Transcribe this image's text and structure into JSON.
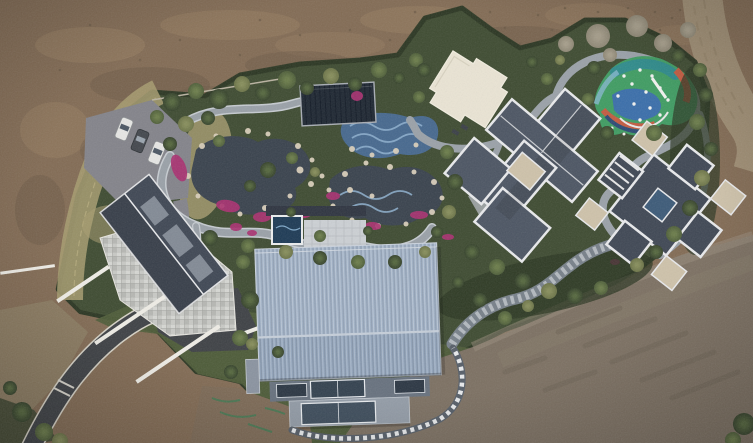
{
  "scene": {
    "description": "Aerial drone view of a landscaped private estate: koi ponds with winding stone paths, a colorful playground, four buildings (stone-roof house, barn with blue metal roof, two gray hip-roof villas), a parking lot with three cars, surrounded by bare graded dirt",
    "counts": {
      "cars": 3,
      "buildings": 5,
      "ponds": 2
    },
    "trees": [
      [
        172,
        102,
        9,
        "d"
      ],
      [
        196,
        91,
        8,
        "m"
      ],
      [
        219,
        99,
        10,
        "d"
      ],
      [
        242,
        84,
        8,
        "o"
      ],
      [
        263,
        93,
        8,
        "d"
      ],
      [
        287,
        80,
        9,
        "m"
      ],
      [
        307,
        88,
        7,
        "d"
      ],
      [
        331,
        76,
        8,
        "o"
      ],
      [
        355,
        84,
        7,
        "d"
      ],
      [
        379,
        70,
        8,
        "m"
      ],
      [
        399,
        78,
        6,
        "d"
      ],
      [
        416,
        60,
        7,
        "m"
      ],
      [
        186,
        124,
        8,
        "o"
      ],
      [
        170,
        144,
        7,
        "d"
      ],
      [
        157,
        117,
        7,
        "m"
      ],
      [
        268,
        170,
        8,
        "d"
      ],
      [
        292,
        158,
        6,
        "m"
      ],
      [
        250,
        186,
        6,
        "d"
      ],
      [
        315,
        172,
        5,
        "o"
      ],
      [
        210,
        238,
        8,
        "d"
      ],
      [
        248,
        246,
        7,
        "m"
      ],
      [
        286,
        252,
        7,
        "o"
      ],
      [
        320,
        258,
        7,
        "d"
      ],
      [
        358,
        262,
        7,
        "m"
      ],
      [
        395,
        262,
        7,
        "d"
      ],
      [
        425,
        252,
        6,
        "o"
      ],
      [
        447,
        152,
        7,
        "m"
      ],
      [
        455,
        182,
        8,
        "d"
      ],
      [
        449,
        212,
        7,
        "o"
      ],
      [
        437,
        232,
        6,
        "d"
      ],
      [
        424,
        70,
        7,
        "d"
      ],
      [
        419,
        97,
        6,
        "m"
      ],
      [
        532,
        62,
        6,
        "d"
      ],
      [
        547,
        79,
        6,
        "m"
      ],
      [
        560,
        60,
        5,
        "o"
      ],
      [
        594,
        68,
        7,
        "d"
      ],
      [
        588,
        99,
        6,
        "m"
      ],
      [
        607,
        133,
        7,
        "d"
      ],
      [
        654,
        133,
        8,
        "m"
      ],
      [
        678,
        56,
        7,
        "d"
      ],
      [
        700,
        70,
        7,
        "m"
      ],
      [
        706,
        95,
        7,
        "d"
      ],
      [
        697,
        122,
        8,
        "m"
      ],
      [
        711,
        149,
        7,
        "d"
      ],
      [
        702,
        178,
        8,
        "o"
      ],
      [
        690,
        208,
        8,
        "d"
      ],
      [
        674,
        234,
        8,
        "m"
      ],
      [
        656,
        252,
        7,
        "d"
      ],
      [
        637,
        265,
        7,
        "o"
      ],
      [
        472,
        252,
        8,
        "d"
      ],
      [
        497,
        267,
        8,
        "m"
      ],
      [
        523,
        281,
        8,
        "d"
      ],
      [
        549,
        291,
        8,
        "o"
      ],
      [
        575,
        296,
        8,
        "d"
      ],
      [
        601,
        288,
        7,
        "m"
      ],
      [
        250,
        300,
        9,
        "d"
      ],
      [
        240,
        338,
        8,
        "m"
      ],
      [
        252,
        344,
        6,
        "o"
      ],
      [
        278,
        352,
        6,
        "d"
      ],
      [
        231,
        372,
        7,
        "d"
      ],
      [
        480,
        300,
        7,
        "d"
      ],
      [
        505,
        318,
        7,
        "m"
      ],
      [
        528,
        306,
        6,
        "o"
      ],
      [
        458,
        282,
        6,
        "d"
      ],
      [
        320,
        236,
        6,
        "m"
      ],
      [
        368,
        231,
        5,
        "d"
      ],
      [
        291,
        212,
        5,
        "d"
      ],
      [
        744,
        424,
        11,
        "d"
      ],
      [
        733,
        440,
        8,
        "m"
      ],
      [
        22,
        412,
        10,
        "d"
      ],
      [
        44,
        432,
        9,
        "m"
      ],
      [
        10,
        388,
        7,
        "d"
      ],
      [
        60,
        441,
        8,
        "o"
      ],
      [
        243,
        262,
        7,
        "m"
      ],
      [
        208,
        118,
        7,
        "d"
      ],
      [
        219,
        141,
        6,
        "m"
      ],
      [
        598,
        36,
        12,
        "b"
      ],
      [
        637,
        26,
        11,
        "b"
      ],
      [
        663,
        43,
        9,
        "b"
      ],
      [
        566,
        44,
        8,
        "b"
      ],
      [
        610,
        55,
        7,
        "b"
      ],
      [
        688,
        30,
        8,
        "b"
      ]
    ],
    "rocks": [
      [
        202,
        146,
        3
      ],
      [
        216,
        136,
        2.5
      ],
      [
        248,
        131,
        3
      ],
      [
        268,
        134,
        2.5
      ],
      [
        298,
        146,
        3
      ],
      [
        312,
        160,
        2.5
      ],
      [
        311,
        184,
        3
      ],
      [
        290,
        196,
        2.5
      ],
      [
        265,
        208,
        3
      ],
      [
        240,
        214,
        2.5
      ],
      [
        222,
        206,
        2.5
      ],
      [
        198,
        196,
        2.5
      ],
      [
        188,
        176,
        3
      ],
      [
        345,
        174,
        3
      ],
      [
        366,
        163,
        2.5
      ],
      [
        390,
        167,
        3
      ],
      [
        414,
        172,
        2.5
      ],
      [
        434,
        182,
        3
      ],
      [
        442,
        198,
        2.5
      ],
      [
        432,
        212,
        3
      ],
      [
        406,
        224,
        2.5
      ],
      [
        378,
        226,
        3
      ],
      [
        352,
        220,
        2.5
      ],
      [
        333,
        206,
        2.5
      ],
      [
        329,
        190,
        2.5
      ],
      [
        352,
        149,
        3
      ],
      [
        372,
        155,
        2.5
      ],
      [
        396,
        151,
        3
      ],
      [
        416,
        145,
        2.5
      ],
      [
        300,
        170,
        3.5
      ],
      [
        350,
        190,
        3
      ],
      [
        372,
        196,
        2.5
      ],
      [
        322,
        176,
        2.5
      ]
    ],
    "flowers": [
      [
        179,
        168,
        7,
        14,
        -20
      ],
      [
        228,
        206,
        12,
        6,
        10
      ],
      [
        262,
        217,
        9,
        5,
        0
      ],
      [
        301,
        213,
        10,
        5,
        8
      ],
      [
        333,
        196,
        7,
        4,
        0
      ],
      [
        373,
        226,
        8,
        4,
        5
      ],
      [
        419,
        215,
        9,
        4,
        0
      ],
      [
        448,
        237,
        6,
        3,
        0
      ],
      [
        236,
        227,
        6,
        4,
        0
      ],
      [
        252,
        233,
        5,
        3,
        0
      ],
      [
        357,
        96,
        6,
        5,
        0
      ],
      [
        615,
        262,
        5,
        3,
        0
      ]
    ],
    "dirt_streaks": [
      [
        90,
        45,
        55,
        18,
        "light",
        0.45
      ],
      [
        230,
        25,
        70,
        15,
        "light",
        0.4
      ],
      [
        420,
        20,
        60,
        14,
        "light",
        0.4
      ],
      [
        590,
        15,
        45,
        12,
        "light",
        0.35
      ],
      [
        55,
        130,
        35,
        28,
        "light",
        0.4
      ],
      [
        330,
        45,
        55,
        13,
        "light",
        0.35
      ],
      [
        680,
        35,
        30,
        10,
        "light",
        0.3
      ],
      [
        150,
        85,
        60,
        18,
        "dark",
        0.45
      ],
      [
        300,
        65,
        55,
        14,
        "dark",
        0.4
      ],
      [
        520,
        38,
        55,
        12,
        "dark",
        0.4
      ],
      [
        640,
        55,
        35,
        10,
        "dark",
        0.4
      ],
      [
        40,
        210,
        25,
        35,
        "dark",
        0.45
      ],
      [
        110,
        150,
        30,
        20,
        "dark",
        0.4
      ],
      [
        210,
        100,
        40,
        14,
        "dark",
        0.35
      ]
    ],
    "dirt_speckles": [
      [
        455,
        18
      ],
      [
        470,
        35
      ],
      [
        490,
        12
      ],
      [
        505,
        28
      ],
      [
        520,
        44
      ],
      [
        538,
        15
      ],
      [
        552,
        30
      ],
      [
        565,
        8
      ],
      [
        580,
        22
      ],
      [
        598,
        12
      ],
      [
        610,
        30
      ],
      [
        628,
        8
      ],
      [
        640,
        20
      ],
      [
        655,
        12
      ],
      [
        470,
        52
      ],
      [
        488,
        40
      ],
      [
        430,
        30
      ],
      [
        415,
        12
      ],
      [
        660,
        30
      ],
      [
        672,
        18
      ],
      [
        560,
        48
      ],
      [
        540,
        55
      ],
      [
        600,
        45
      ],
      [
        625,
        40
      ],
      [
        260,
        20
      ],
      [
        180,
        40
      ],
      [
        300,
        35
      ],
      [
        90,
        25
      ],
      [
        140,
        60
      ],
      [
        60,
        70
      ],
      [
        240,
        55
      ],
      [
        350,
        30
      ],
      [
        390,
        40
      ],
      [
        680,
        10
      ],
      [
        700,
        25
      ],
      [
        730,
        60
      ],
      [
        740,
        90
      ],
      [
        735,
        120
      ]
    ],
    "tracks": [
      "M558,332 l62,-24",
      "M585,346 l70,-27",
      "M612,362 l74,-29",
      "M642,380 l72,-28",
      "M672,398 l66,-26",
      "M545,390 l50,-18",
      "M505,372 l40,-14"
    ],
    "paint_marks": [
      "M212,398 q14,6 28,2",
      "M220,412 q18,8 36,3",
      "M248,424 q12,4 24,8",
      "M265,408 q10,2 20,6"
    ]
  },
  "palette": {
    "dirt_top": "#826b54",
    "dirt_light": "#9b8264",
    "dirt_dark": "#6a5845",
    "dirt_bottom": "#7c7062",
    "dirt_patch": "#7e6b57",
    "dirt_road": "#9e8d73",
    "garden": "#3e4b31",
    "hedge": "#2b3622",
    "lawn": "#4e5c38",
    "dry_grass": "#a79c70",
    "asphalt": "#3e4145",
    "road_edge": "#d6d2c6",
    "parking": "#83838a",
    "path": "#9aa1a8",
    "path_light": "#c6cbd0",
    "pond": "#39424d",
    "rock": "#d9cfbb",
    "flower": "#a93070",
    "pool_tile": "#46688e",
    "pool_wave": "#8fb2d0",
    "pavilion": "#1e2732",
    "white_pad": "#eae4d4",
    "pg_green": "#3f9c62",
    "pg_blue": "#3a6cae",
    "pg_teal": "#2e8b8b",
    "pg_red": "#c35b40",
    "pg_sky": "#85b7cd",
    "roof_dark": "#4c5563",
    "roof_darker": "#3f4754",
    "roof_tan": "#cec2aa",
    "ridge": "#e9eaec",
    "stone": "#c8c9c5",
    "wall_white": "#efede6",
    "barn_roof": "#a0b1c6",
    "barn_roof_low": "#94a6bd",
    "barn_wall": "#67717e",
    "window": "#2b3643",
    "deck": "#939ca7",
    "spa": "#1d3a55",
    "tree_dark": "#35422b",
    "tree_mid": "#4e5e39",
    "tree_olive": "#6b7347",
    "tree_bare": "#8d8674",
    "car_white": "#e6e6e4",
    "car_dark": "#43474d",
    "track": "#6c6153",
    "paint_green": "#3f7a52"
  }
}
